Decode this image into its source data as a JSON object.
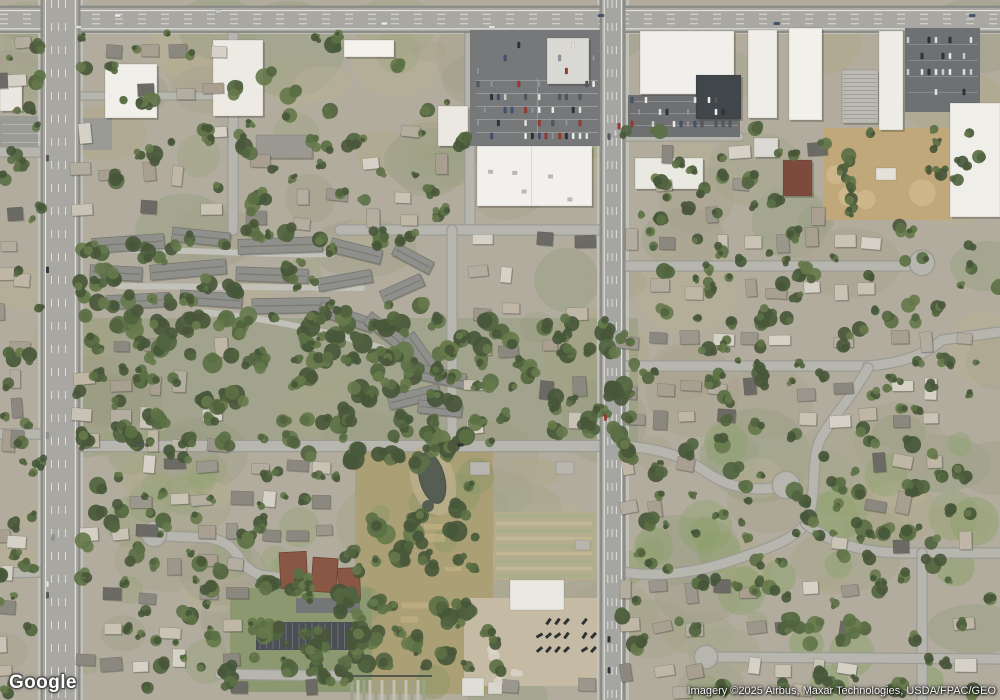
{
  "map": {
    "provider_logo": "Google",
    "attribution": "Imagery ©2025 Airbus, Maxar Technologies, USDA/FPAC/GEO"
  }
}
